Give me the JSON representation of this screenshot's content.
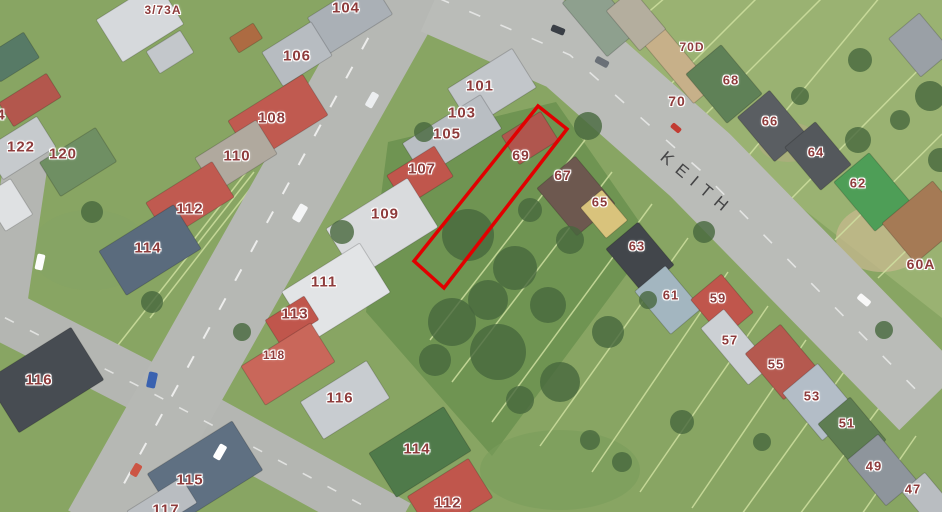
{
  "map": {
    "street_label": "KEITH",
    "street_label_color": "#3a3a3c",
    "parcel_label_color": "#8e3b3b",
    "highlight_color": "#e10000",
    "highlighted_parcel": {
      "points": "538,106 567,129 444,288 414,261"
    },
    "parcel_labels": [
      {
        "label": "3/73A",
        "x": 163,
        "y": 10,
        "size": 12
      },
      {
        "label": "104",
        "x": 346,
        "y": 8,
        "size": 15
      },
      {
        "label": "106",
        "x": 297,
        "y": 56,
        "size": 15
      },
      {
        "label": "4",
        "x": 1,
        "y": 115,
        "size": 15
      },
      {
        "label": "122",
        "x": 21,
        "y": 147,
        "size": 15
      },
      {
        "label": "120",
        "x": 63,
        "y": 154,
        "size": 15
      },
      {
        "label": "108",
        "x": 272,
        "y": 118,
        "size": 15
      },
      {
        "label": "110",
        "x": 237,
        "y": 156,
        "size": 15
      },
      {
        "label": "101",
        "x": 480,
        "y": 86,
        "size": 15
      },
      {
        "label": "103",
        "x": 462,
        "y": 113,
        "size": 15
      },
      {
        "label": "105",
        "x": 447,
        "y": 134,
        "size": 15
      },
      {
        "label": "107",
        "x": 422,
        "y": 169,
        "size": 15
      },
      {
        "label": "109",
        "x": 385,
        "y": 214,
        "size": 15
      },
      {
        "label": "112",
        "x": 190,
        "y": 209,
        "size": 15
      },
      {
        "label": "114",
        "x": 148,
        "y": 248,
        "size": 15
      },
      {
        "label": "111",
        "x": 324,
        "y": 282,
        "size": 15
      },
      {
        "label": "113",
        "x": 295,
        "y": 314,
        "size": 15
      },
      {
        "label": "118",
        "x": 274,
        "y": 355,
        "size": 12
      },
      {
        "label": "116",
        "x": 39,
        "y": 380,
        "size": 15
      },
      {
        "label": "116",
        "x": 340,
        "y": 398,
        "size": 15
      },
      {
        "label": "114",
        "x": 417,
        "y": 449,
        "size": 15
      },
      {
        "label": "115",
        "x": 190,
        "y": 480,
        "size": 15
      },
      {
        "label": "117",
        "x": 166,
        "y": 510,
        "size": 15
      },
      {
        "label": "112",
        "x": 448,
        "y": 503,
        "size": 15
      },
      {
        "label": "69",
        "x": 521,
        "y": 155,
        "size": 14
      },
      {
        "label": "67",
        "x": 563,
        "y": 175,
        "size": 14
      },
      {
        "label": "65",
        "x": 600,
        "y": 202,
        "size": 13
      },
      {
        "label": "63",
        "x": 637,
        "y": 246,
        "size": 13
      },
      {
        "label": "61",
        "x": 671,
        "y": 295,
        "size": 13
      },
      {
        "label": "59",
        "x": 718,
        "y": 298,
        "size": 13
      },
      {
        "label": "57",
        "x": 730,
        "y": 340,
        "size": 13
      },
      {
        "label": "55",
        "x": 776,
        "y": 364,
        "size": 13
      },
      {
        "label": "53",
        "x": 812,
        "y": 396,
        "size": 13
      },
      {
        "label": "51",
        "x": 847,
        "y": 423,
        "size": 13
      },
      {
        "label": "49",
        "x": 874,
        "y": 466,
        "size": 13
      },
      {
        "label": "47",
        "x": 913,
        "y": 489,
        "size": 13
      },
      {
        "label": "70D",
        "x": 692,
        "y": 47,
        "size": 12
      },
      {
        "label": "70",
        "x": 677,
        "y": 101,
        "size": 14
      },
      {
        "label": "68",
        "x": 731,
        "y": 80,
        "size": 13
      },
      {
        "label": "66",
        "x": 770,
        "y": 121,
        "size": 13
      },
      {
        "label": "64",
        "x": 816,
        "y": 152,
        "size": 13
      },
      {
        "label": "62",
        "x": 858,
        "y": 183,
        "size": 13
      },
      {
        "label": "60A",
        "x": 921,
        "y": 264,
        "size": 14
      }
    ]
  }
}
